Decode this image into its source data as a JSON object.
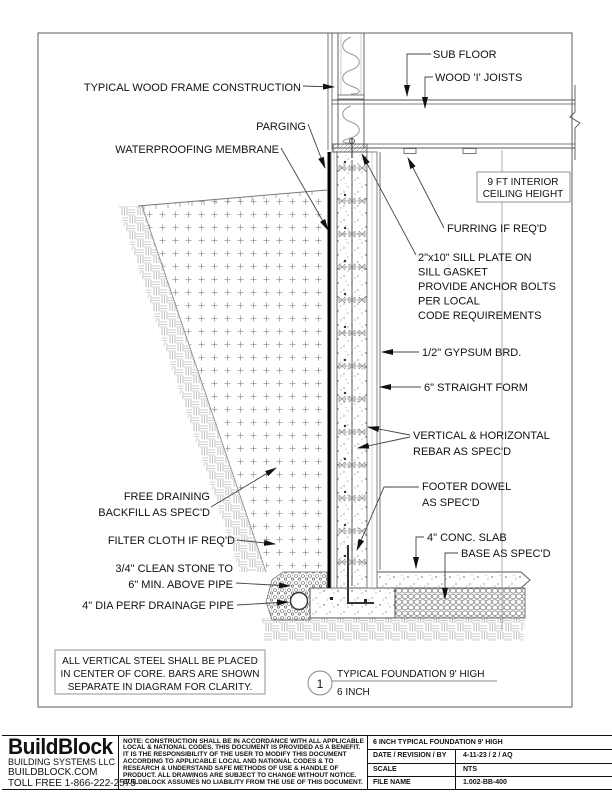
{
  "drawing": {
    "labels": {
      "typ_wood_frame": "TYPICAL WOOD FRAME CONSTRUCTION",
      "parging": "PARGING",
      "waterproofing": "WATERPROOFING MEMBRANE",
      "sub_floor": "SUB FLOOR",
      "wood_i_joists": "WOOD 'I' JOISTS",
      "ceiling_height": [
        "9 FT INTERIOR",
        "CEILING HEIGHT"
      ],
      "furring": "FURRING IF REQ'D",
      "sill_plate": [
        "2\"x10\" SILL PLATE ON",
        "SILL GASKET",
        "PROVIDE ANCHOR BOLTS",
        "PER LOCAL",
        "CODE REQUIREMENTS"
      ],
      "gypsum": "1/2\" GYPSUM BRD.",
      "straight_form": "6\" STRAIGHT FORM",
      "rebar": [
        "VERTICAL & HORIZONTAL",
        "REBAR AS SPEC'D"
      ],
      "footer_dowel": [
        "FOOTER DOWEL",
        "AS SPEC'D"
      ],
      "conc_slab": "4\" CONC. SLAB",
      "base": "BASE AS SPEC'D",
      "free_draining": [
        "FREE DRAINING",
        "BACKFILL AS SPEC'D"
      ],
      "filter_cloth": "FILTER CLOTH IF REQ'D",
      "clean_stone": [
        "3/4\" CLEAN STONE TO",
        "6\" MIN. ABOVE PIPE"
      ],
      "drainage_pipe": "4\" DIA PERF DRAINAGE PIPE"
    },
    "note_box": [
      "ALL VERTICAL STEEL SHALL BE PLACED",
      "IN CENTER OF CORE. BARS ARE SHOWN",
      "SEPARATE IN DIAGRAM FOR CLARITY."
    ],
    "callout": {
      "number": "1",
      "title": "TYPICAL FOUNDATION 9' HIGH",
      "subtitle": "6 INCH"
    }
  },
  "title_block": {
    "logo": {
      "name": "BuildBlock",
      "line1": "BUILDING SYSTEMS LLC",
      "line2": "BUILDBLOCK.COM",
      "line3": "TOLL FREE 1-866-222-2575"
    },
    "note_lines": [
      "NOTE: CONSTRUCTION SHALL BE IN ACCORDANCE WITH ALL APPLICABLE",
      "LOCAL & NATIONAL CODES. THIS DOCUMENT IS PROVIDED AS A BENEFIT.",
      "IT IS THE RESPONSIBILITY OF THE USER TO MODIFY THIS DOCUMENT",
      "ACCORDING TO APPLICABLE LOCAL AND NATIONAL CODES & TO",
      "RESEARCH & UNDERSTAND SAFE METHODS OF USE & HANDLE OF",
      "PRODUCT. ALL DRAWINGS ARE SUBJECT TO CHANGE WITHOUT NOTICE.",
      "BUILDBLOCK ASSUMES NO LIABILITY FROM THE USE OF THIS DOCUMENT."
    ],
    "info": {
      "title": "6 INCH TYPICAL FOUNDATION 9' HIGH",
      "rows": [
        {
          "label": "DATE / REVISION / BY",
          "value": "4-11-23 / 2 / AQ"
        },
        {
          "label": "SCALE",
          "value": "NTS"
        },
        {
          "label": "FILE NAME",
          "value": "1.002-BB-400"
        }
      ]
    }
  },
  "colors": {
    "line": "#444444",
    "hatch": "#999999",
    "membrane": "#000000",
    "text": "#111111",
    "background": "#ffffff"
  }
}
